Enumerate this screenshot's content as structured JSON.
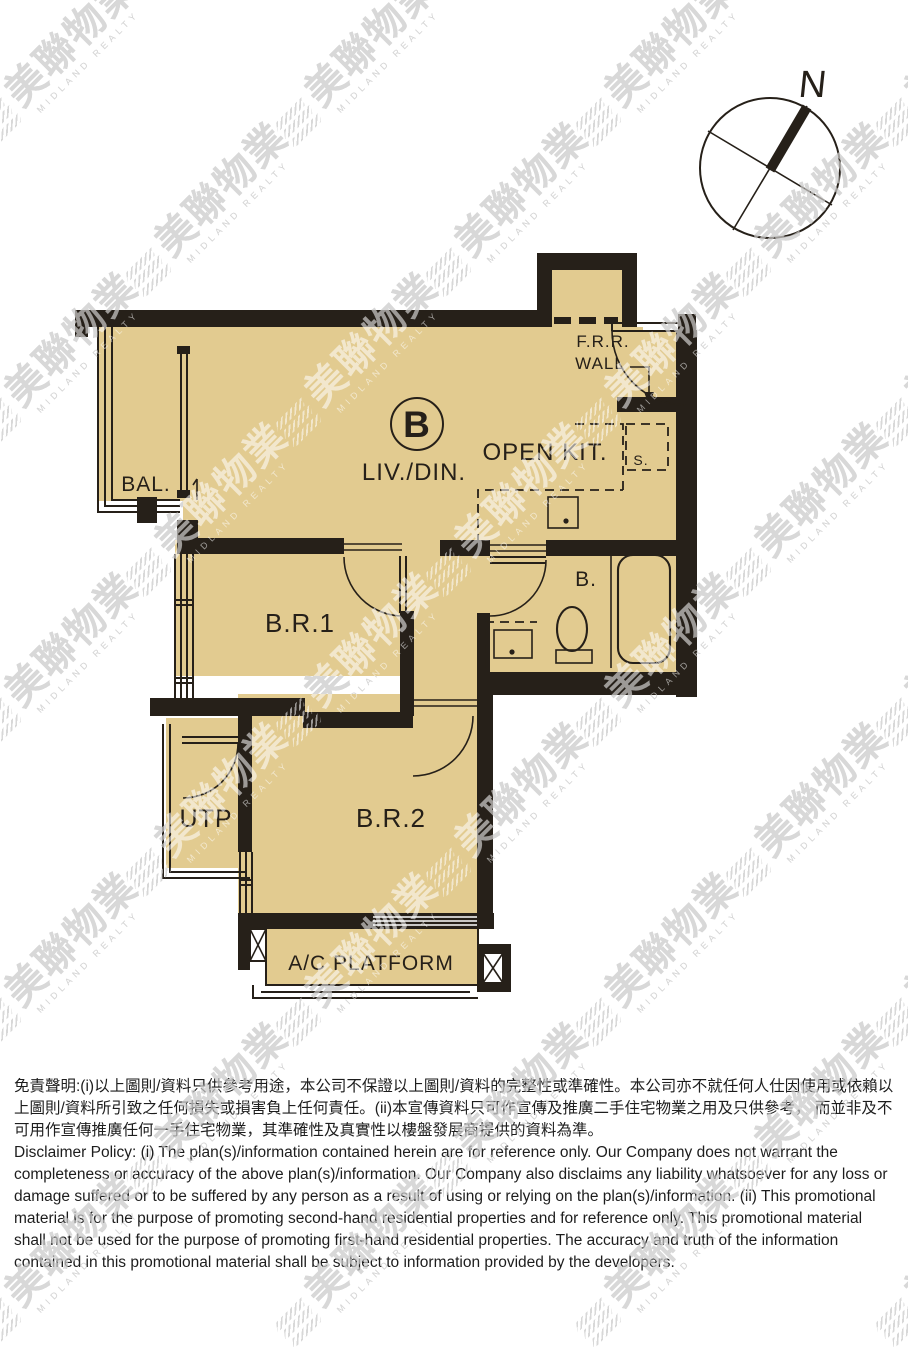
{
  "unit": {
    "label": "B"
  },
  "rooms": {
    "balcony": "BAL.",
    "living_dining": "LIV./DIN.",
    "open_kitchen": "OPEN KIT.",
    "frr_wall_line1": "F.R.R.",
    "frr_wall_line2": "WALL",
    "store": "S.",
    "bedroom1": "B.R.1",
    "bathroom": "B.",
    "utility_platform": "UTP",
    "bedroom2": "B.R.2",
    "ac_platform": "A/C PLATFORM"
  },
  "compass": {
    "north_label": "N"
  },
  "watermark": {
    "cjk": "美聯物業",
    "en": "MIDLAND REALTY"
  },
  "disclaimer": {
    "zh": "免責聲明:(i)以上圖則/資料只供參考用途，本公司不保證以上圖則/資料的完整性或準確性。本公司亦不就任何人仕因使用或依賴以上圖則/資料所引致之任何損失或損害負上任何責任。(ii)本宣傳資料只可作宣傳及推廣二手住宅物業之用及只供參考， 而並非及不可用作宣傳推廣任何一手住宅物業，其準確性及真實性以樓盤發展商提供的資料為準。",
    "en": "Disclaimer Policy: (i) The plan(s)/information contained herein are for reference only. Our Company does not warrant the completeness or accuracy of the above plan(s)/information. Our Company also disclaims any liability whatsoever for any loss or damage suffered or to be suffered by any person as a result of using or relying on the plan(s)/information. (ii) This promotional material is for the purpose of promoting second-hand residential properties and for reference only. This promotional material shall not be used for the purpose of promoting first-hand residential properties. The accuracy and truth of the information contained in this promotional material shall be subject to information provided by the developers."
  },
  "colors": {
    "floor": "#e2cb90",
    "wall": "#262019",
    "text": "#1d1d1d",
    "watermark_under": "#a9a9a9"
  }
}
